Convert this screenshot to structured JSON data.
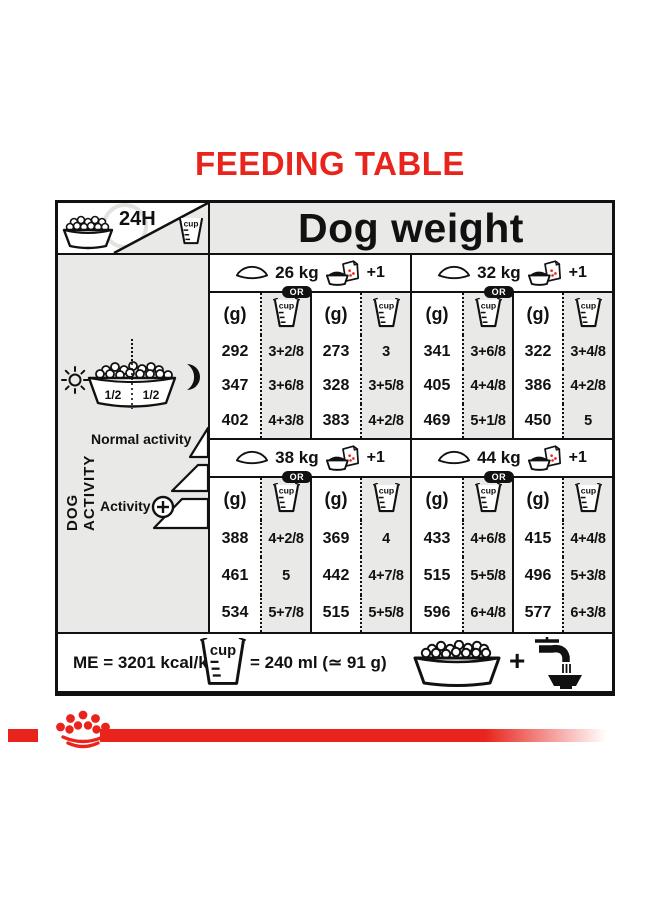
{
  "title": "FEEDING TABLE",
  "colors": {
    "accent_red": "#e8241c",
    "table_gray": "#e9e9e7",
    "ink": "#111111"
  },
  "icons": {
    "kibble-bowl-icon": "bowl filled with kibble",
    "clock-icon": "24h clock ring",
    "cup-icon": "measuring cup",
    "empty-bowl-icon": "empty bowl (kibble only ration)",
    "bowl-and-pouch-icon": "bowl plus wet-food pouch",
    "sun-icon": "sun (morning meal)",
    "moon-icon": "moon (evening meal)",
    "half-portions-bowl-icon": "bowl split into 1/2 and 1/2",
    "activity-steps-icon": "increasing activity steps",
    "plus-circle-icon": "circled plus",
    "water-tap-icon": "tap filling water bowl",
    "plus-icon": "+",
    "crown-logo": "red crown of dots logo"
  },
  "table": {
    "corner": {
      "duration_label": "24H"
    },
    "dog_weight_header": "Dog weight",
    "or_label": "OR",
    "plus_one_label": "+1",
    "grams_unit_label": "(g)",
    "cup_small_label": "cup",
    "groups": [
      {
        "weight": "26 kg",
        "columns": [
          {
            "grams": [
              "292",
              "347",
              "402"
            ],
            "cups": [
              "3+2/8",
              "3+6/8",
              "4+3/8"
            ]
          },
          {
            "grams": [
              "273",
              "328",
              "383"
            ],
            "cups": [
              "3",
              "3+5/8",
              "4+2/8"
            ]
          }
        ]
      },
      {
        "weight": "32 kg",
        "columns": [
          {
            "grams": [
              "341",
              "405",
              "469"
            ],
            "cups": [
              "3+6/8",
              "4+4/8",
              "5+1/8"
            ]
          },
          {
            "grams": [
              "322",
              "386",
              "450"
            ],
            "cups": [
              "3+4/8",
              "4+2/8",
              "5"
            ]
          }
        ]
      },
      {
        "weight": "38 kg",
        "columns": [
          {
            "grams": [
              "388",
              "461",
              "534"
            ],
            "cups": [
              "4+2/8",
              "5",
              "5+7/8"
            ]
          },
          {
            "grams": [
              "369",
              "442",
              "515"
            ],
            "cups": [
              "4",
              "4+7/8",
              "5+5/8"
            ]
          }
        ]
      },
      {
        "weight": "44 kg",
        "columns": [
          {
            "grams": [
              "433",
              "515",
              "596"
            ],
            "cups": [
              "4+6/8",
              "5+5/8",
              "6+4/8"
            ]
          },
          {
            "grams": [
              "415",
              "496",
              "577"
            ],
            "cups": [
              "4+4/8",
              "5+3/8",
              "6+3/8"
            ]
          }
        ]
      }
    ],
    "sidebar": {
      "vertical_label": "DOG ACTIVITY",
      "bowl_half_left": "1/2",
      "bowl_half_right": "1/2",
      "normal_activity_label": "Normal activity",
      "activity_label": "Activity"
    },
    "footer": {
      "me_label": "ME = 3201 kcal/kg",
      "cup_label": "cup",
      "cup_equivalence": "= 240 ml (≃ 91 g)",
      "plus_sign": "+"
    }
  }
}
